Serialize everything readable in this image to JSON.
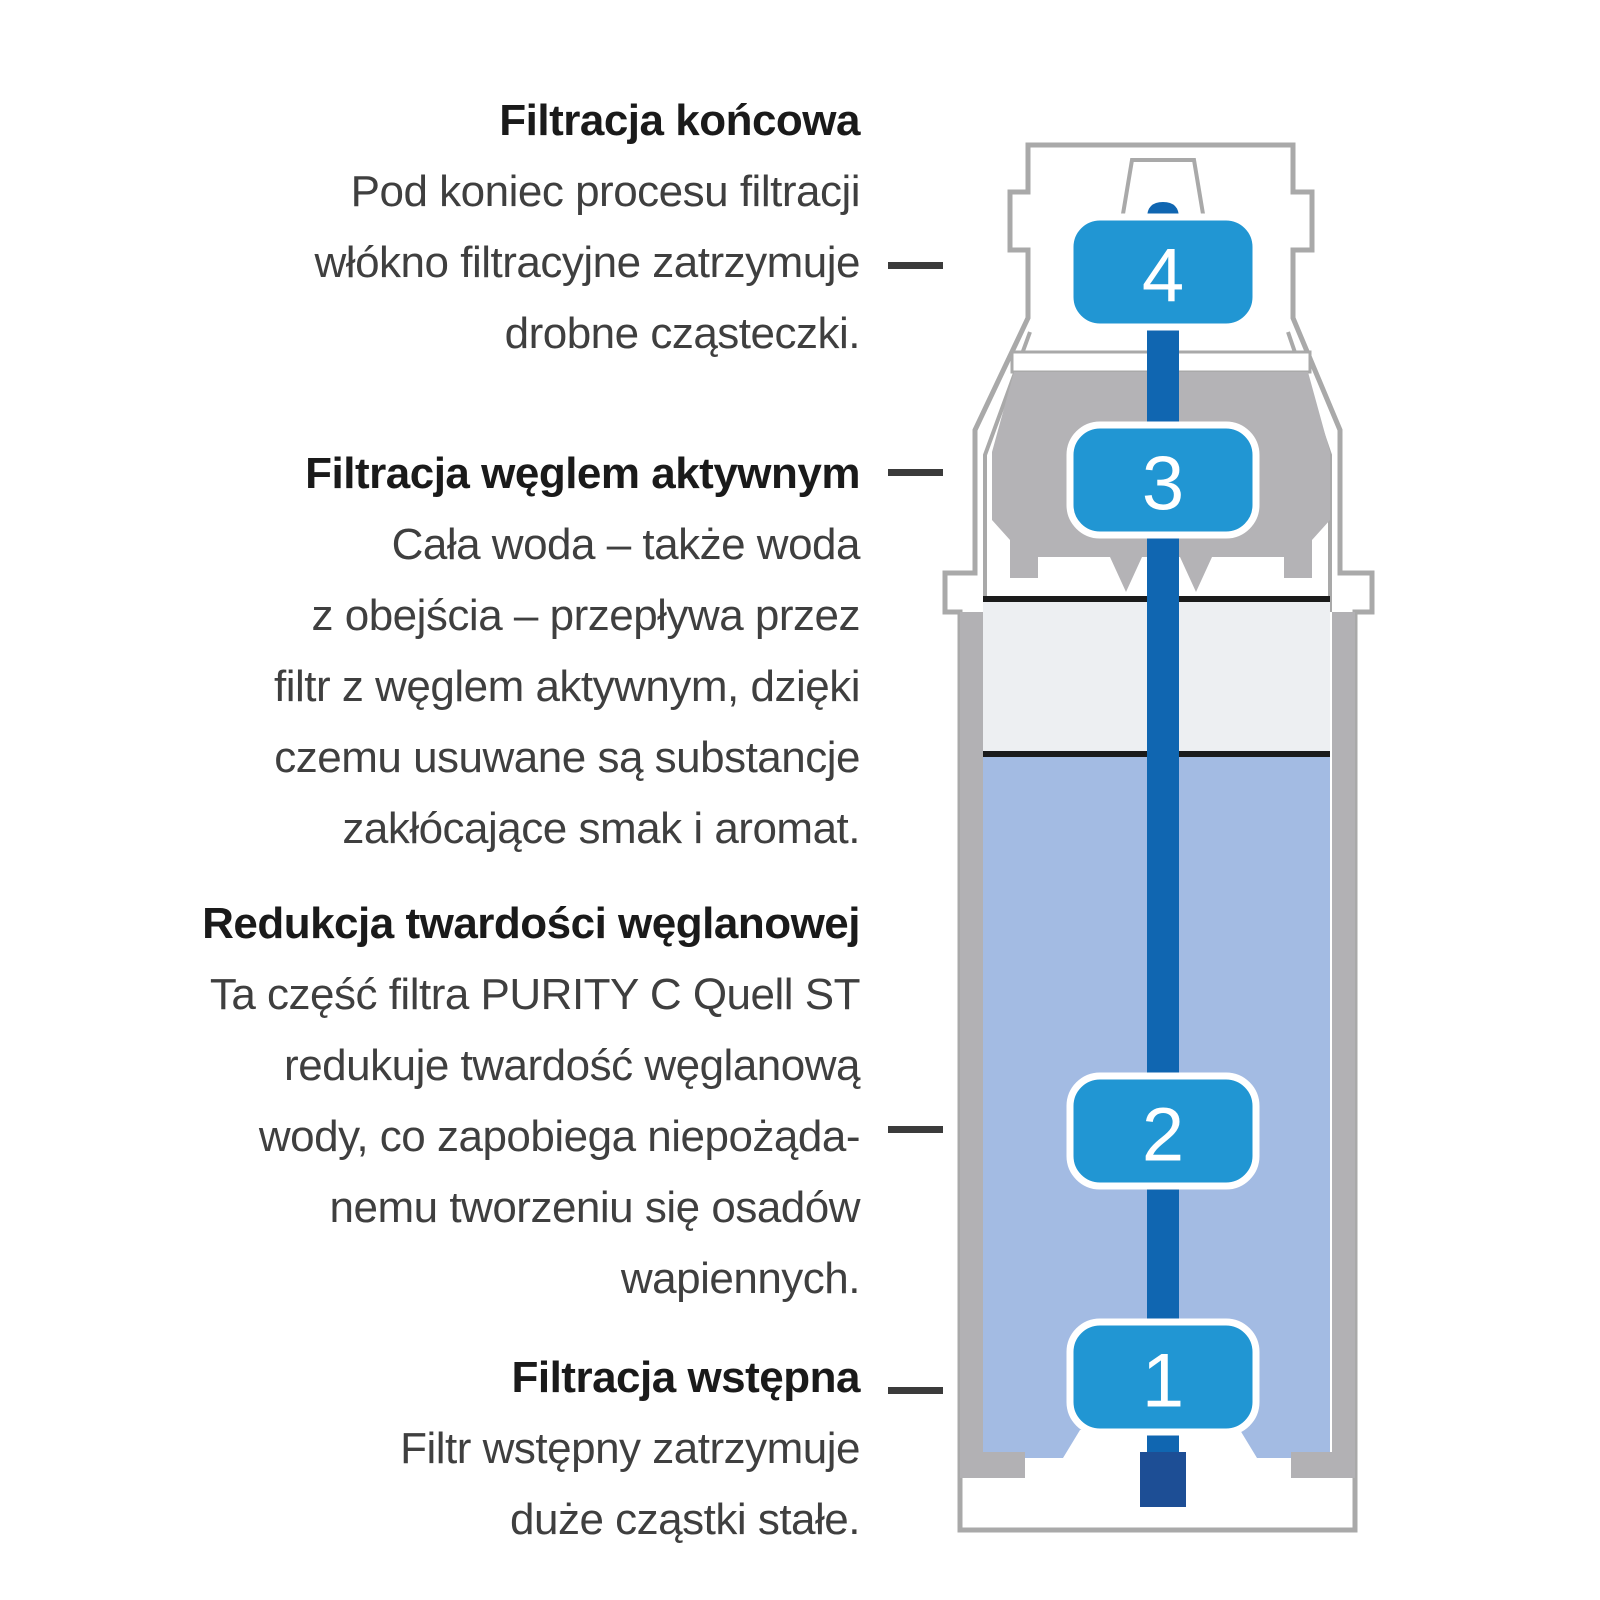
{
  "annotations": [
    {
      "heading": "Filtracja końcowa",
      "lines": [
        "Pod koniec procesu filtracji",
        "włókno filtracyjne zatrzymuje",
        "drobne cząsteczki."
      ]
    },
    {
      "heading": "Filtracja węglem aktywnym",
      "lines": [
        "Cała woda – także woda",
        "z obejścia – przepływa przez",
        "filtr z węglem aktywnym, dzięki",
        "czemu usuwane są substancje",
        "zakłócające smak i aromat."
      ]
    },
    {
      "heading": "Redukcja twardości węglanowej",
      "lines": [
        "Ta część filtra PURITY C Quell ST",
        "redukuje twardość węglanową",
        "wody, co zapobiega niepożąda-",
        "nemu tworzeniu się osadów",
        "wapiennych."
      ]
    },
    {
      "heading": "Filtracja wstępna",
      "lines": [
        "Filtr wstępny zatrzymuje",
        "duże cząstki stałe."
      ]
    }
  ],
  "badges": [
    "4",
    "3",
    "2",
    "1"
  ],
  "colors": {
    "badge_blue": "#2196d3",
    "tube_blue": "#1066b1",
    "tube_end_navy": "#1d4e95",
    "water_blue": "#a3bbe3",
    "carbon_gray": "#b4b3b6",
    "wall_gray": "#b2b1b4",
    "outline_gray": "#a9a9a9",
    "divider_black": "#1b1b1b",
    "section_light": "#edeff2",
    "connector_dark": "#3b3b3b"
  }
}
